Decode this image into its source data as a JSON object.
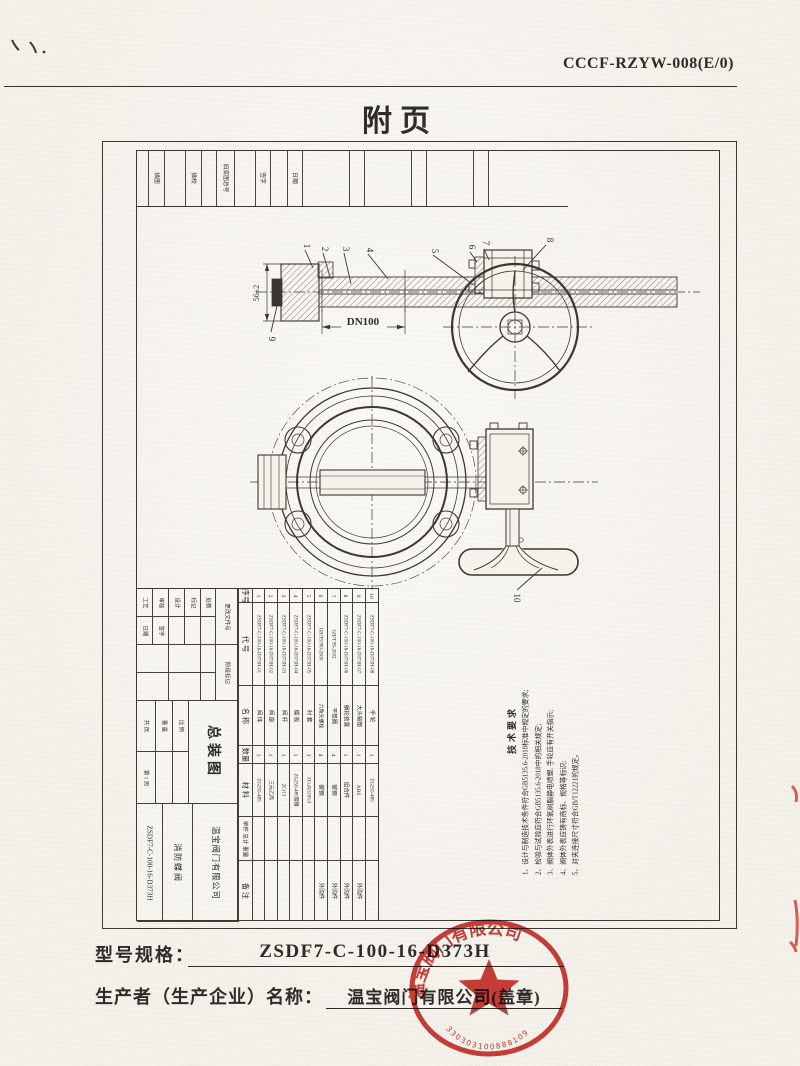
{
  "page": {
    "header_code": "CCCF-RZYW-008(E/0)",
    "title": "附页"
  },
  "border_strip": {
    "labels": [
      "描图",
      "描校",
      "旧底图总号",
      "签字",
      "日期"
    ]
  },
  "drawing": {
    "dimensions": {
      "dn": "DN100",
      "width_tol": "56±2"
    },
    "part_numbers": [
      "1",
      "2",
      "3",
      "4",
      "5",
      "6",
      "7",
      "8",
      "9",
      "10"
    ]
  },
  "tech_notes": {
    "heading": "技术要求",
    "lines": [
      "1、设计与制造技术条件符合GB5135.6-2018标准中规定的要求;",
      "2、检验与试验应符合GB5135.6-2018中的相关规定;",
      "3、阀体外表进行环氧树脂静电喷塑, 手轮应有开关指示;",
      "4、阀体外表应铸有商标、规格等标识;",
      "5、对夹连接尺寸符合GB/T12221的规定。"
    ]
  },
  "parts_table": {
    "headers": {
      "no": "序号",
      "code": "代  号",
      "name": "名  称",
      "qty": "数量",
      "material": "材  料",
      "weight": "单件 总计 重量",
      "remark": "备  注"
    },
    "rows": [
      {
        "no": "1",
        "code": "ZSDF7-C-100-16-D373H-01",
        "name": "阀 体",
        "qty": "1",
        "material": "ZG250-485",
        "remark": ""
      },
      {
        "no": "2",
        "code": "ZSDF7-C-100-16-D373H-02",
        "name": "阀 座",
        "qty": "1",
        "material": "三元乙丙",
        "remark": ""
      },
      {
        "no": "3",
        "code": "ZSDF7-C-100-16-D373H-03",
        "name": "阀 杆",
        "qty": "1",
        "material": "2Cr13",
        "remark": ""
      },
      {
        "no": "4",
        "code": "ZSDF7-C-100-16-D373H-04",
        "name": "蝶 板",
        "qty": "1",
        "material": "ZG250-485镀镍",
        "remark": ""
      },
      {
        "no": "5",
        "code": "ZSDF7-C-100-16-D373H-05",
        "name": "衬 套",
        "qty": "3",
        "material": "ZCuAl10Fe3",
        "remark": ""
      },
      {
        "no": "6",
        "code": "GB/T5780-2000",
        "name": "六角头螺栓",
        "qty": "4",
        "material": "碳钢",
        "remark": "外购件"
      },
      {
        "no": "7",
        "code": "GB/T 95-2002",
        "name": "平垫圈",
        "qty": "4",
        "material": "碳钢",
        "remark": "外购件"
      },
      {
        "no": "8",
        "code": "ZSDF7-C-100-16-D373H-06",
        "name": "蜗轮装置",
        "qty": "1",
        "material": "组合件",
        "remark": "外购件"
      },
      {
        "no": "9",
        "code": "ZSDF7-C-100-16-D373H-07",
        "name": "大头轴垫",
        "qty": "1",
        "material": "ABS",
        "remark": "外购件"
      },
      {
        "no": "10",
        "code": "ZSDF7-C-100-16-D373H-08",
        "name": "手 轮",
        "qty": "1",
        "material": "ZG250-485",
        "remark": ""
      }
    ]
  },
  "title_block": {
    "fields": {
      "process": "工艺",
      "check": "审核",
      "design": "设计",
      "mark": "标记",
      "count": "处数",
      "change_doc": "更改文件号",
      "sign": "签字",
      "date": "日期",
      "stage_mark": "阶段标记",
      "weight": "重 量",
      "scale": "比 例",
      "sheets": "共  页",
      "page_no": "第 1 页"
    },
    "drawing_name": "总装图",
    "drawing_code": "ZSDF7-C-100-16-D373H",
    "product": "消防蝶阀",
    "company": "温宝阀门有限公司"
  },
  "footer": {
    "model_label": "型号规格：",
    "model_value": "ZSDF7-C-100-16-D373H",
    "producer_label": "生产者（生产企业）名称：",
    "producer_value": "温宝阀门有限公司(盖章)"
  },
  "stamp": {
    "company_ring": "温宝阀门有限公司",
    "serial": "330303100888109",
    "color": "#c8251f"
  }
}
